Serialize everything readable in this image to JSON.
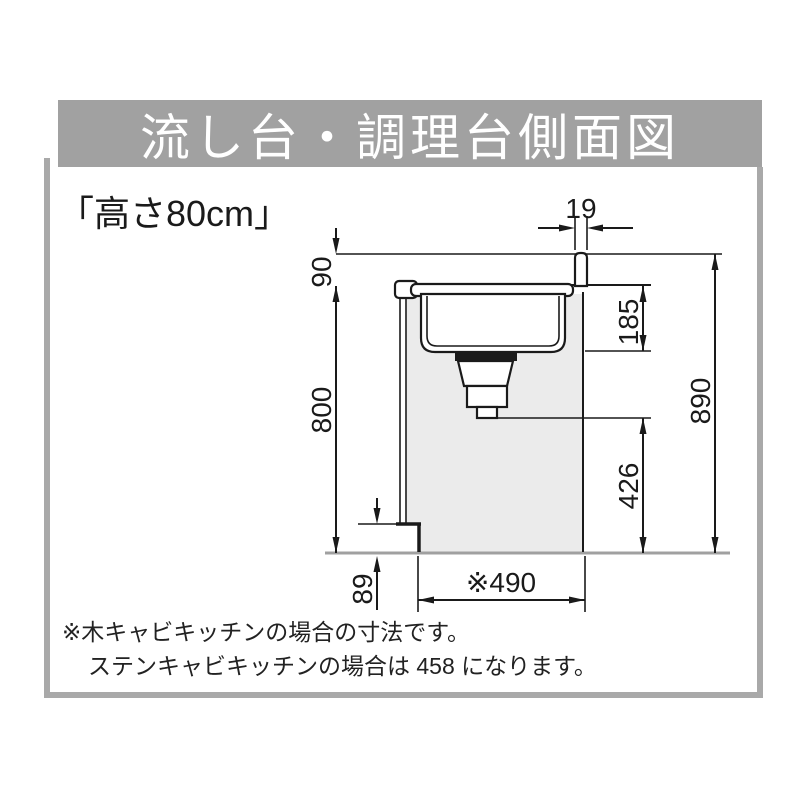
{
  "header": {
    "title": "流し台・調理台側面図"
  },
  "subtitle": "「高さ80cm」",
  "diagram": {
    "description": "流し台・調理台の側面図（高さ80cmタイプ）",
    "dims": {
      "lip_width": "19",
      "backsplash_height": "90",
      "sink_depth": "185",
      "counter_height": "800",
      "total_height": "890",
      "drain_clearance": "426",
      "toe_kick_height": "89",
      "cabinet_depth": "※490"
    }
  },
  "footnotes": {
    "line1": "※木キャビキッチンの場合の寸法です。",
    "line2": "ステンキャビキッチンの場合は 458 になります。"
  },
  "colors": {
    "header_bg": "#a1a1a1",
    "frame_gray": "#a9a9a9",
    "cabinet_fill": "#ebebeb",
    "line_black": "#1a1a1a",
    "floor_gray": "#a0a0a0",
    "title_text": "#ffffff"
  }
}
